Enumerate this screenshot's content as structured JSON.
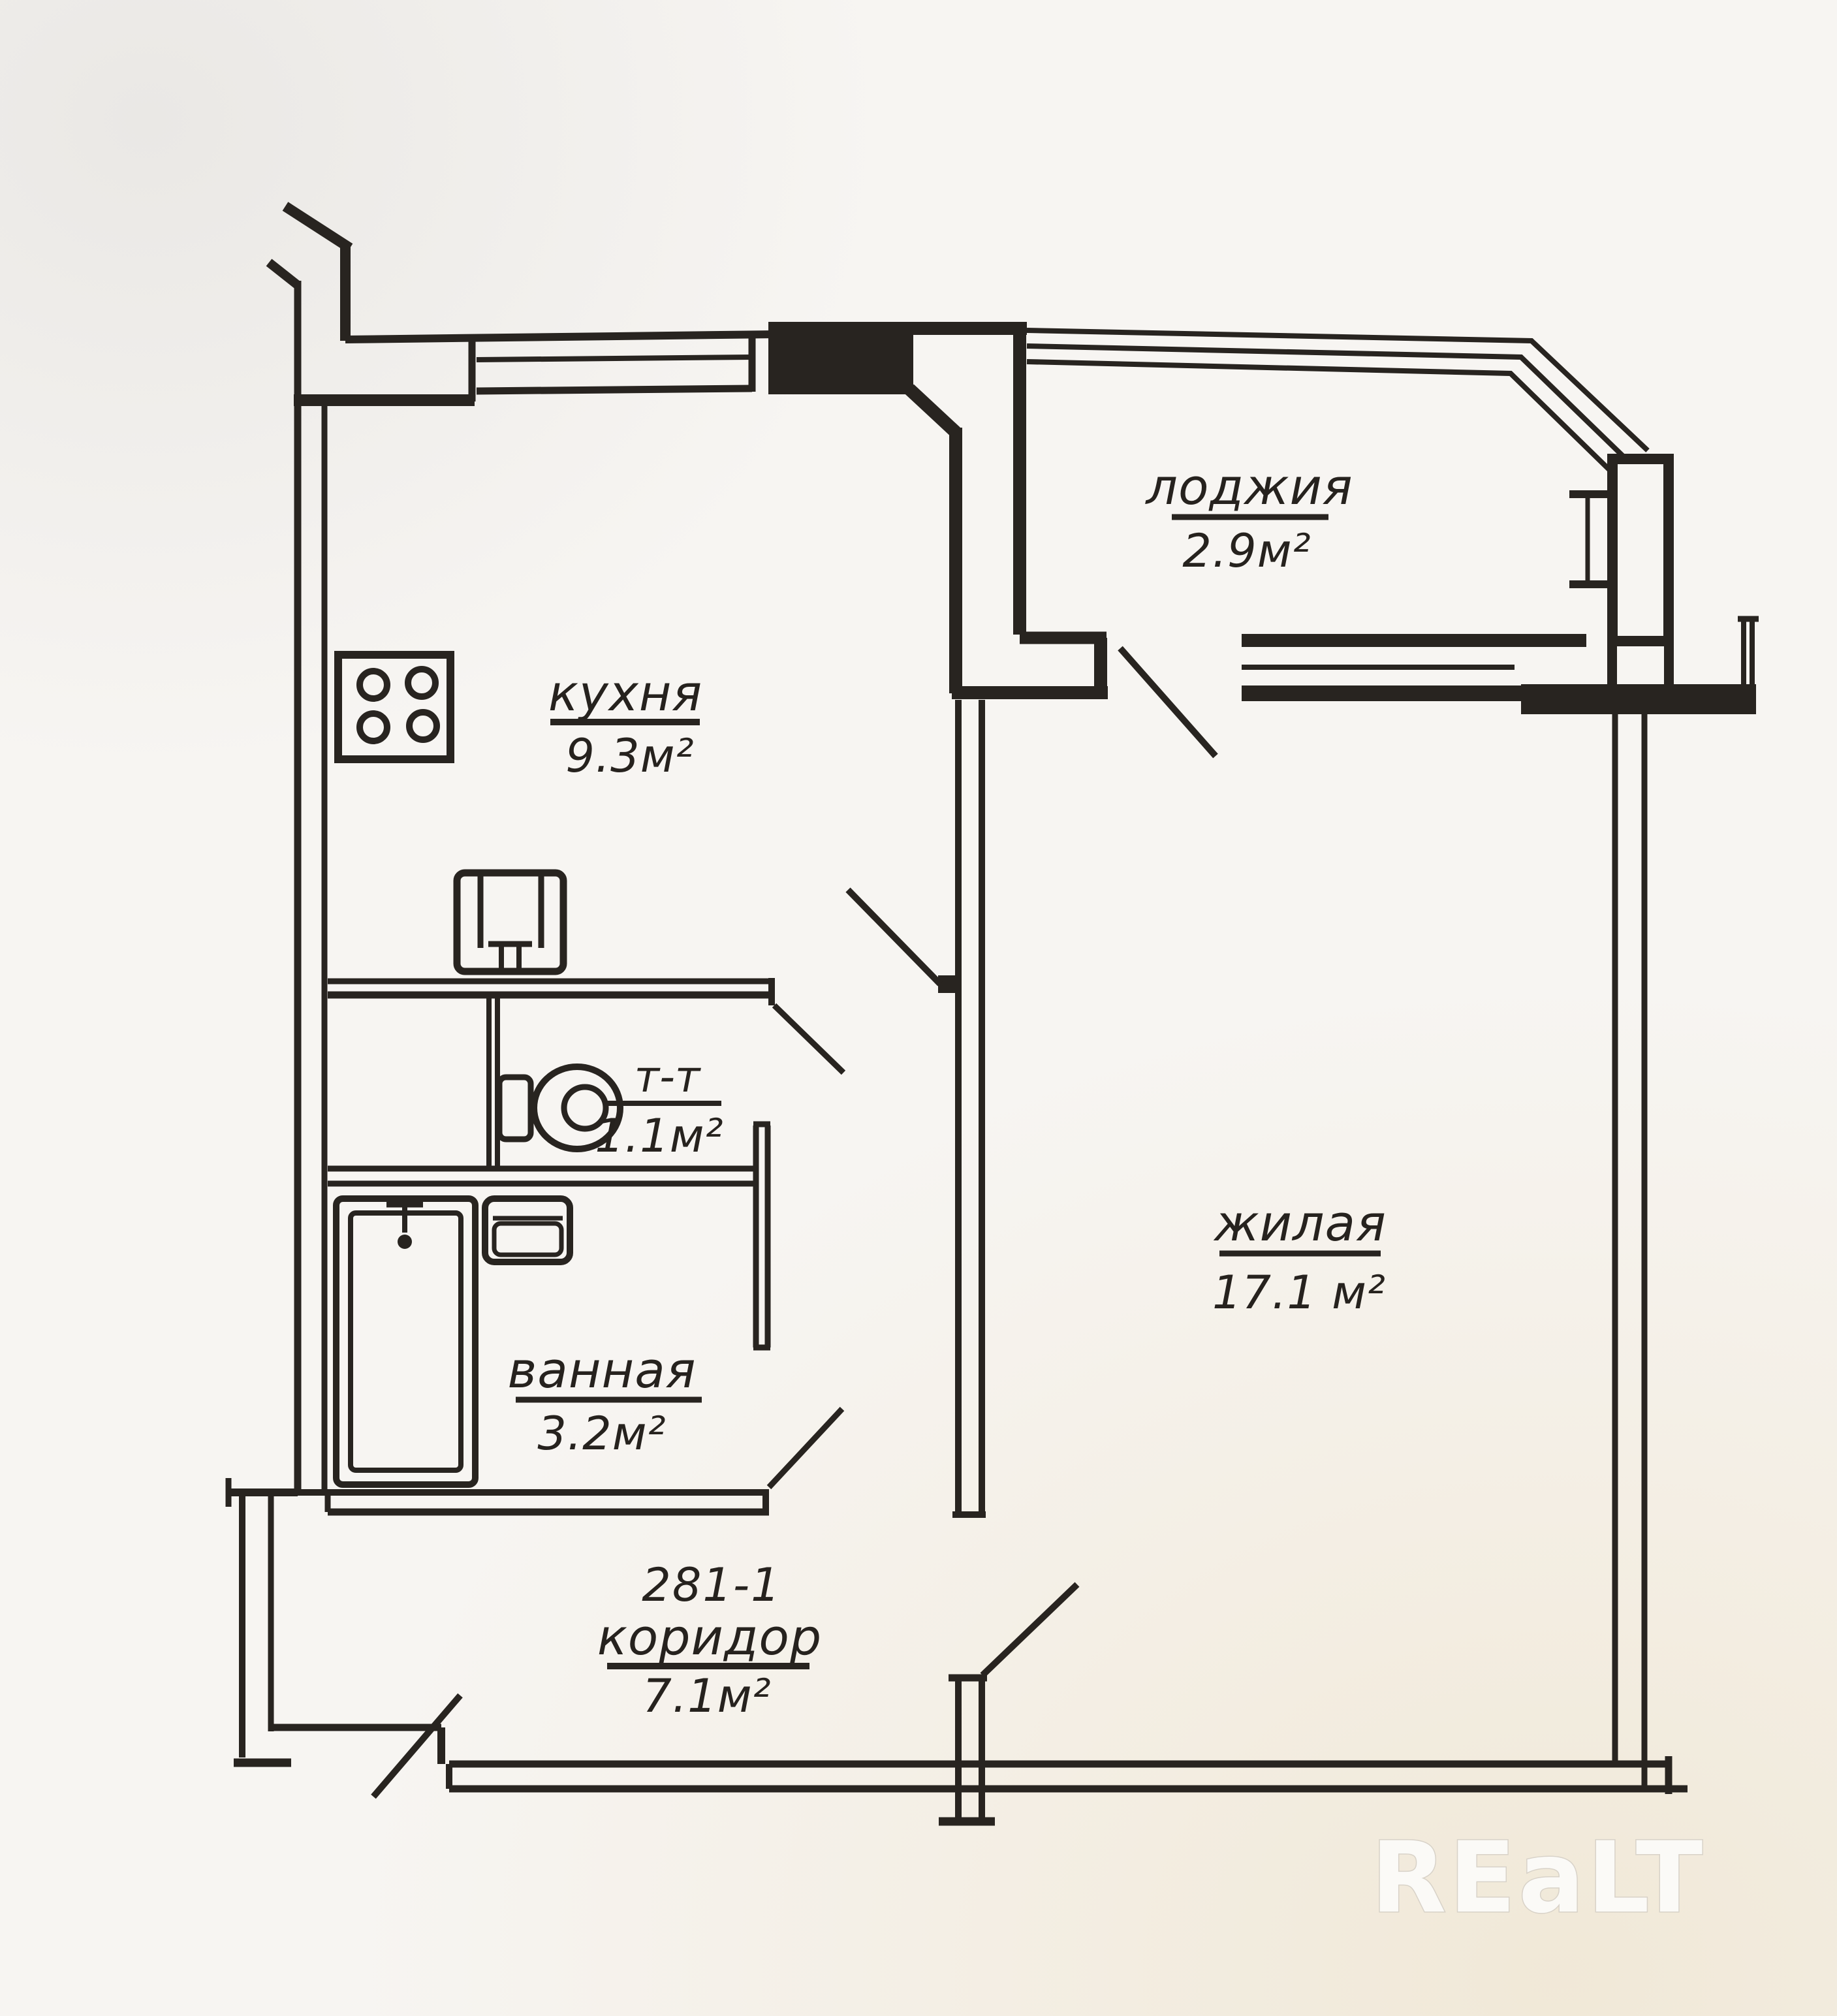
{
  "title": "Apartment floor plan",
  "plan": {
    "unit_number": "281-1",
    "rooms": [
      {
        "key": "loggia",
        "name": "лоджия",
        "area": "2.9м²"
      },
      {
        "key": "kitchen",
        "name": "кухня",
        "area": "9.3м²"
      },
      {
        "key": "toilet",
        "name": "т-т",
        "area": "1.1м²"
      },
      {
        "key": "bathroom",
        "name": "ванная",
        "area": "3.2м²"
      },
      {
        "key": "living",
        "name": "жилая",
        "area": "17.1 м²"
      },
      {
        "key": "corridor",
        "name": "коридор",
        "area": "7.1м²"
      }
    ],
    "fixtures": [
      "stove-icon",
      "kitchen-sink-icon",
      "toilet-icon",
      "washbasin-icon",
      "bathtub-icon"
    ],
    "door_count": 6
  },
  "watermark": {
    "text": "REaLT"
  },
  "colors": {
    "ink": "#282420",
    "paper": "#f7f5f2",
    "watermark_outline": "#d8d2c8"
  }
}
